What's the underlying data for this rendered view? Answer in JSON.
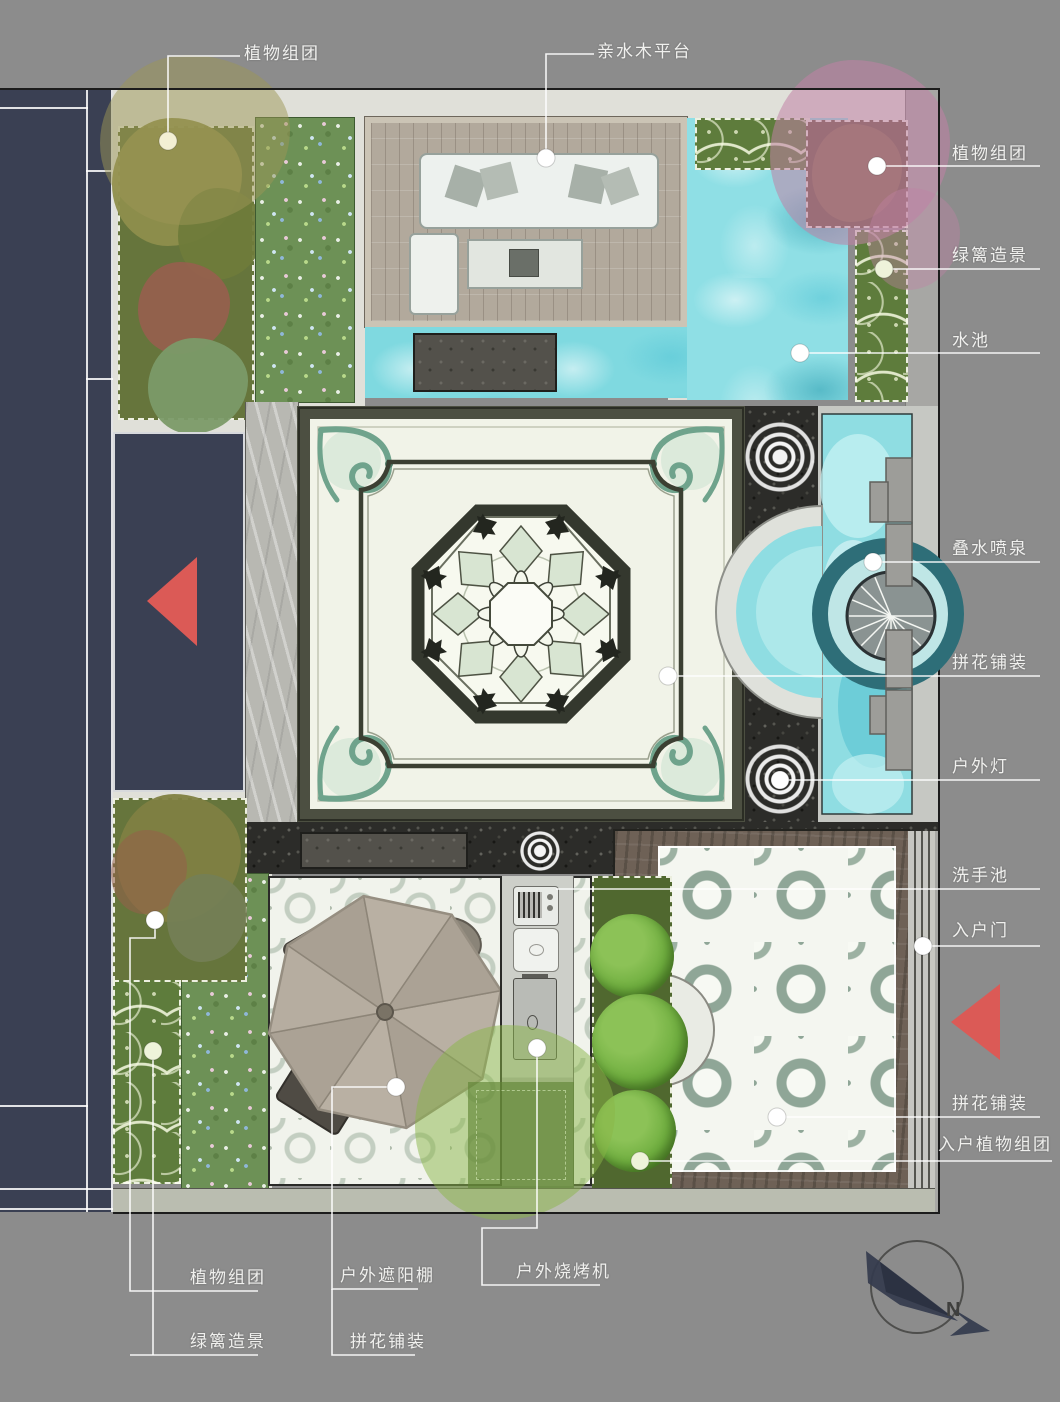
{
  "document": {
    "type": "courtyard-landscape-plan"
  },
  "annotations": [
    {
      "id": "plant-group-top",
      "text": "植物组团"
    },
    {
      "id": "waterside-deck",
      "text": "亲水木平台"
    },
    {
      "id": "plant-group-right",
      "text": "植物组团"
    },
    {
      "id": "hedge-right",
      "text": "绿篱造景"
    },
    {
      "id": "pool",
      "text": "水池"
    },
    {
      "id": "cascade-fountain",
      "text": "叠水喷泉"
    },
    {
      "id": "mosaic-paving-center",
      "text": "拼花铺装"
    },
    {
      "id": "outdoor-light",
      "text": "户外灯"
    },
    {
      "id": "wash-basin",
      "text": "洗手池"
    },
    {
      "id": "entry-door",
      "text": "入户门"
    },
    {
      "id": "mosaic-paving-entry",
      "text": "拼花铺装"
    },
    {
      "id": "entry-plant-group",
      "text": "入户植物组团"
    },
    {
      "id": "plant-group-bottom",
      "text": "植物组团"
    },
    {
      "id": "hedge-bottom",
      "text": "绿篱造景"
    },
    {
      "id": "sunshade",
      "text": "户外遮阳棚"
    },
    {
      "id": "mosaic-paving-patio",
      "text": "拼花铺装"
    },
    {
      "id": "bbq-machine",
      "text": "户外烧烤机"
    }
  ],
  "compass": {
    "north_label": "N"
  },
  "colors": {
    "background": "#8c8c8c",
    "label_text": "#f0f0ee",
    "leader_line": "#ffffff",
    "building": "#3a4053",
    "direction_arrow": "#db5a56",
    "water": "#7fd9e0",
    "lawn": "#6d9156",
    "gravel": "#2c2c29",
    "deck": "#b2a99c",
    "plaza_field": "#f1f3e8",
    "plaza_frame": "#4c4f41"
  }
}
